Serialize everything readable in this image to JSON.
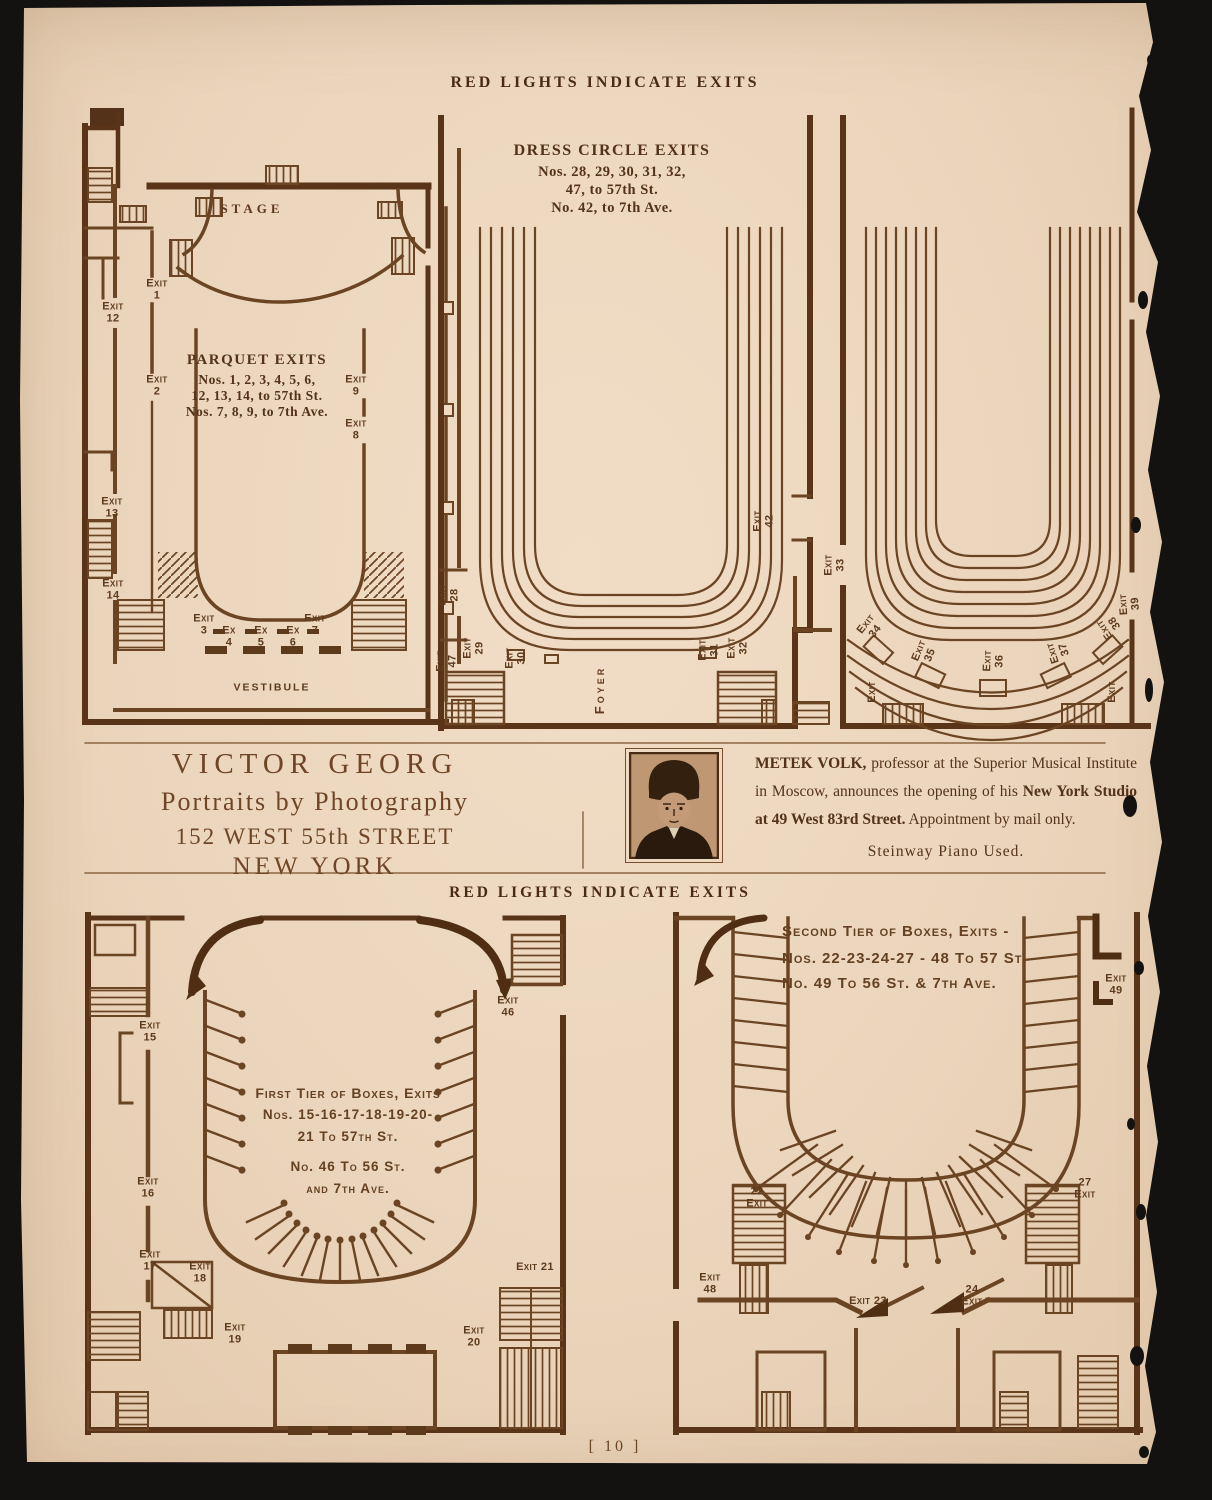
{
  "page": {
    "top_header": "RED LIGHTS INDICATE EXITS",
    "middle_header": "RED LIGHTS INDICATE EXITS",
    "page_number": "[ 10 ]"
  },
  "colors": {
    "paper": "#ecd6bd",
    "ink": "#6b4423",
    "wall": "#5a3418",
    "background": "#141210"
  },
  "plans": {
    "parquet": {
      "stage": "STAGE",
      "vestibule": "VESTIBULE",
      "title": "PARQUET EXITS",
      "lines": [
        "Nos. 1, 2, 3, 4, 5, 6,",
        "12, 13, 14, to 57th St.",
        "Nos. 7, 8, 9, to 7th Ave."
      ],
      "exits": [
        "Exit\n1",
        "Exit\n12",
        "Exit\n2",
        "Exit\n9",
        "Exit\n8",
        "Exit\n13",
        "Exit\n14",
        "Exit\n3",
        "Ex\n4",
        "Ex\n5",
        "Ex\n6",
        "Exit\n7"
      ]
    },
    "dress_circle": {
      "title": "DRESS CIRCLE EXITS",
      "lines": [
        "Nos. 28, 29, 30, 31, 32,",
        "47, to 57th St.",
        "No. 42, to 7th Ave."
      ],
      "foyer": "Foyer",
      "exits": [
        "Exit\n28",
        "Exit\n47",
        "Exit\n29",
        "Exit\n30",
        "Exit\n31",
        "Exit\n32",
        "Exit\n42"
      ]
    },
    "balcony": {
      "exits": [
        "Exit\n33",
        "Exit\n34",
        "Exit\n35",
        "Exit\n36",
        "Exit\n37",
        "Exit\n38",
        "Exit\n39",
        "Exit",
        "Exit"
      ]
    },
    "first_tier": {
      "title": "First Tier of Boxes, Exits",
      "lines": [
        "Nos. 15-16-17-18-19-20-",
        "21 To 57th St.",
        "No. 46 To 56 St.",
        "and 7th Ave."
      ],
      "exits": [
        "Exit\n15",
        "Exit\n16",
        "Exit\n17",
        "Exit\n18",
        "Exit\n19",
        "Exit\n20",
        "Exit 21",
        "Exit\n46"
      ]
    },
    "second_tier": {
      "title": "Second Tier of Boxes, Exits -",
      "lines": [
        "Nos. 22-23-24-27 - 48 To 57 St",
        "No. 49 To 56 St. & 7th Ave."
      ],
      "exits": [
        "22\nExit",
        "Exit\n48",
        "Exit 23",
        "24\nExit",
        "27\nExit",
        "Exit\n49"
      ]
    }
  },
  "ads": {
    "victor_georg": {
      "lines": [
        "VICTOR GEORG",
        "Portraits by Photography",
        "152 WEST 55th STREET",
        "NEW YORK"
      ]
    },
    "metek_volk": {
      "name": "METEK VOLK,",
      "t1": " professor at the Superior Musical Institute in Moscow, announces the opening of his ",
      "studio": "New York Studio at 49 West 83rd Street.",
      "t2": "  Appointment by mail only.",
      "footer": "Steinway Piano Used."
    }
  }
}
